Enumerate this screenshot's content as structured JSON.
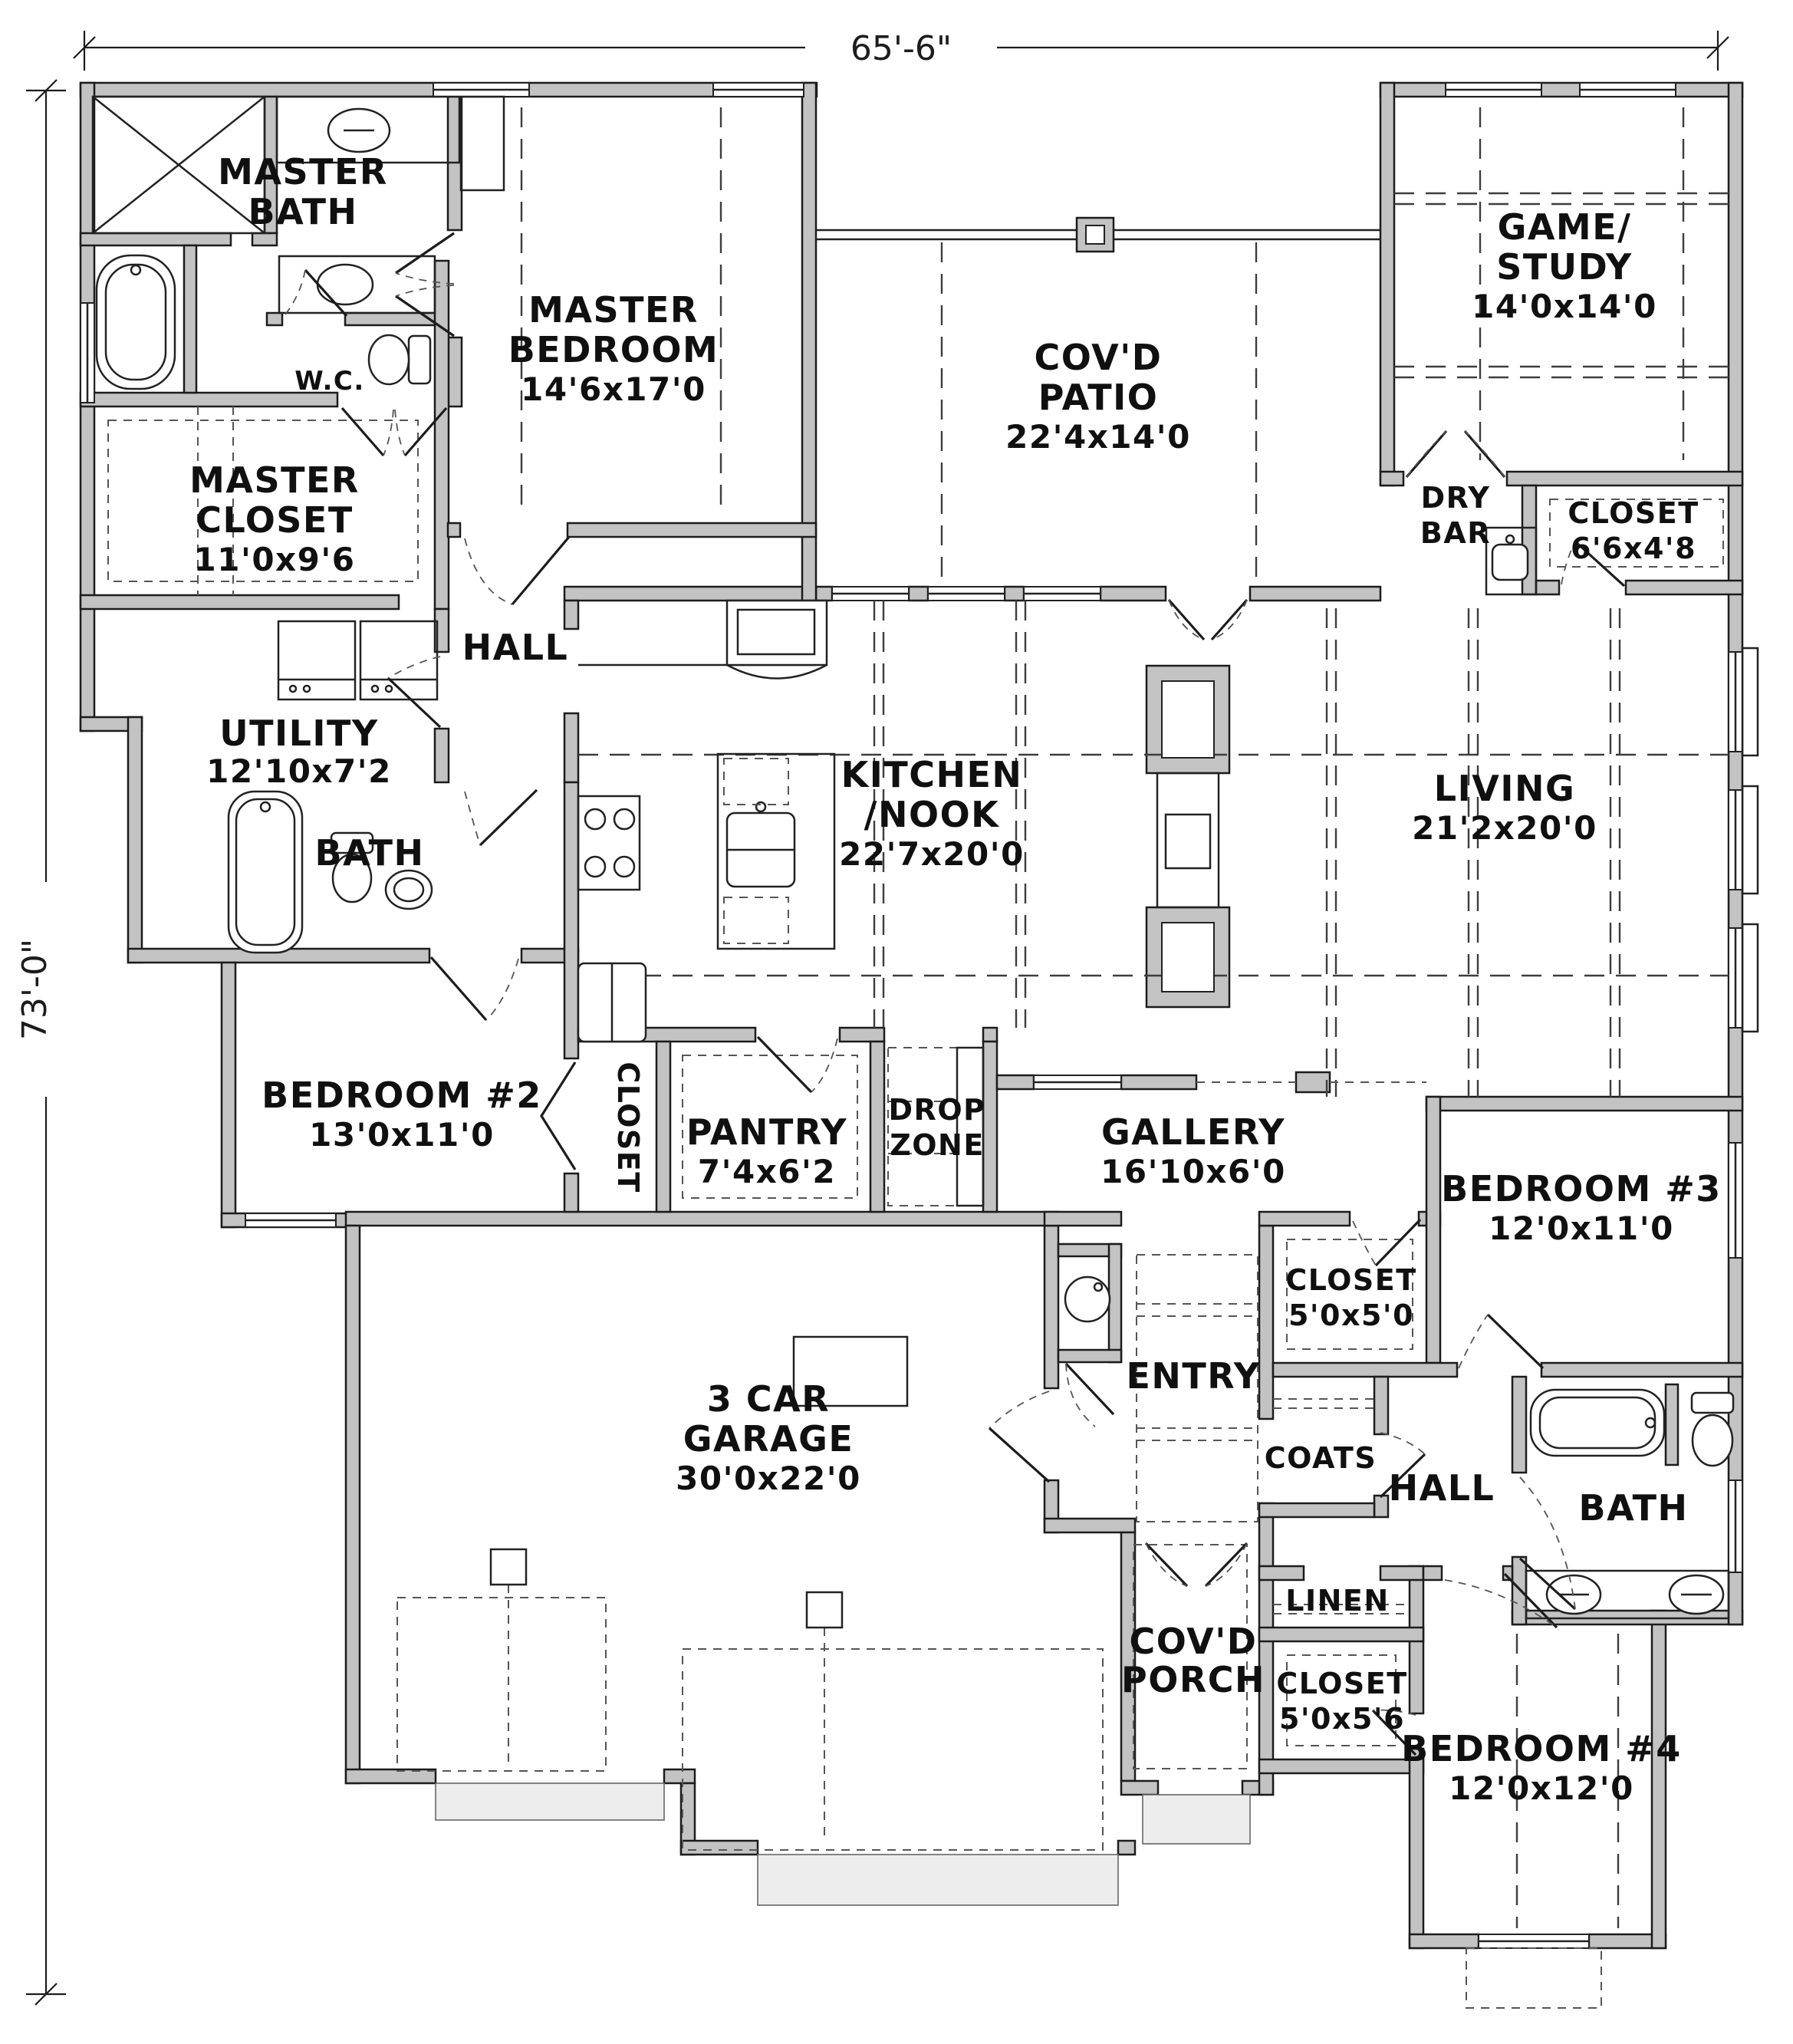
{
  "dimensions": {
    "width_total": "65'-6\"",
    "height_total": "73'-0\""
  },
  "rooms": {
    "master_bath": {
      "l0": "MASTER",
      "l1": "BATH"
    },
    "wc": {
      "l0": "W.C."
    },
    "master_bedroom": {
      "l0": "MASTER",
      "l1": "BEDROOM",
      "l2": "14'6x17'0"
    },
    "covd_patio": {
      "l0": "COV'D",
      "l1": "PATIO",
      "l2": "22'4x14'0"
    },
    "game_study": {
      "l0": "GAME/",
      "l1": "STUDY",
      "l2": "14'0x14'0"
    },
    "master_closet": {
      "l0": "MASTER",
      "l1": "CLOSET",
      "l2": "11'0x9'6"
    },
    "dry_bar": {
      "l0": "DRY",
      "l1": "BAR"
    },
    "closet_game": {
      "l0": "CLOSET",
      "l1": "6'6x4'8"
    },
    "hall_master": {
      "l0": "HALL"
    },
    "utility": {
      "l0": "UTILITY",
      "l1": "12'10x7'2"
    },
    "kitchen_nook": {
      "l0": "KITCHEN",
      "l1": "/NOOK",
      "l2": "22'7x20'0"
    },
    "living": {
      "l0": "LIVING",
      "l1": "21'2x20'0"
    },
    "bath_left": {
      "l0": "BATH"
    },
    "bedroom2": {
      "l0": "BEDROOM #2",
      "l1": "13'0x11'0"
    },
    "closet_bedroom2": {
      "l0": "CLOSET"
    },
    "pantry": {
      "l0": "PANTRY",
      "l1": "7'4x6'2"
    },
    "drop_zone": {
      "l0": "DROP",
      "l1": "ZONE"
    },
    "gallery": {
      "l0": "GALLERY",
      "l1": "16'10x6'0"
    },
    "bedroom3": {
      "l0": "BEDROOM #3",
      "l1": "12'0x11'0"
    },
    "closet_bedroom3": {
      "l0": "CLOSET",
      "l1": "5'0x5'0"
    },
    "entry": {
      "l0": "ENTRY"
    },
    "coats": {
      "l0": "COATS"
    },
    "hall_bedrooms": {
      "l0": "HALL"
    },
    "bath_right": {
      "l0": "BATH"
    },
    "garage": {
      "l0": "3 CAR",
      "l1": "GARAGE",
      "l2": "30'0x22'0"
    },
    "linen": {
      "l0": "LINEN"
    },
    "covd_porch": {
      "l0": "COV'D",
      "l1": "PORCH"
    },
    "closet_bedroom4": {
      "l0": "CLOSET",
      "l1": "5'0x5'6"
    },
    "bedroom4": {
      "l0": "BEDROOM #4",
      "l1": "12'0x12'0"
    }
  },
  "colors": {
    "wall_fill": "#c3c3c3",
    "line": "#1c1c1c",
    "background": "#ffffff"
  }
}
